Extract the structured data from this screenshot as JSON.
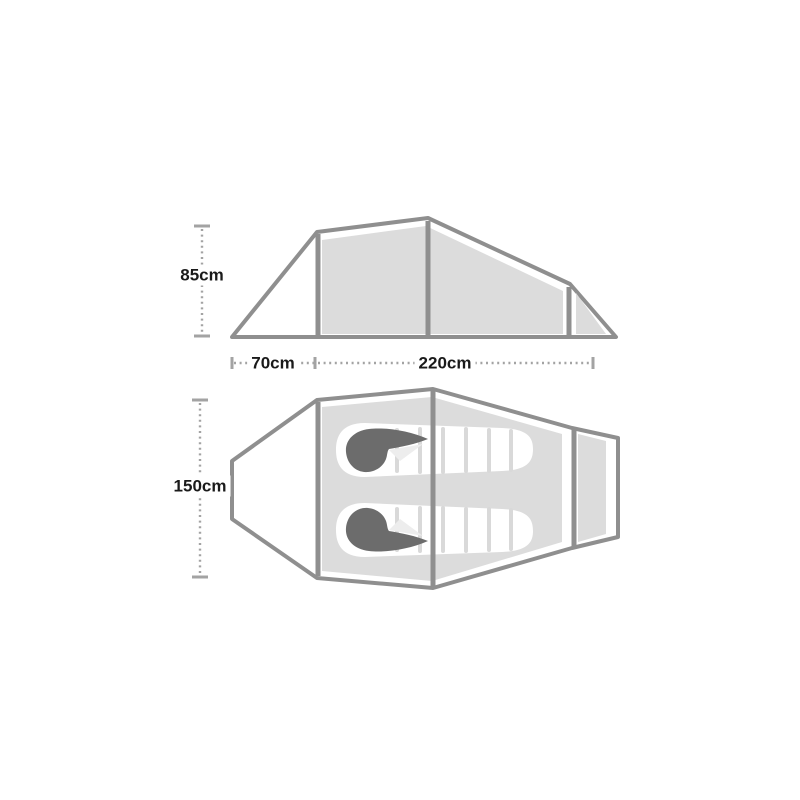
{
  "diagram": {
    "type": "tent-dimensions",
    "views": {
      "side": {
        "height_label": "85cm",
        "front_vestibule_length_label": "70cm",
        "inner_length_label": "220cm"
      },
      "top": {
        "width_label": "150cm",
        "sleeping_bag_count": 2
      }
    },
    "colors": {
      "frame_stroke": "#8f8f8f",
      "tent_fill": "#dcdcdc",
      "vestibule_fill": "#ffffff",
      "sleeping_bag_fill": "#ffffff",
      "hood_fill": "#6c6c6c",
      "baffle_line": "#d9d9d9",
      "flap_highlight": "#ededed",
      "dimension_line": "#a3a3a3",
      "label_text": "#1a1a1a",
      "page_bg": "#ffffff"
    }
  }
}
